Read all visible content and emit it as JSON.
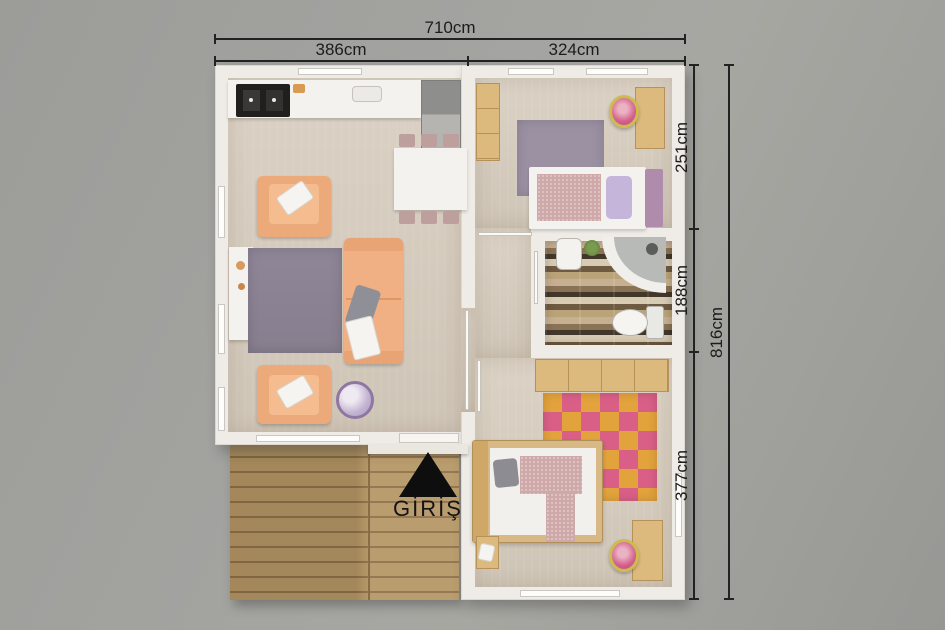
{
  "floorplan": {
    "entrance_label": "GİRİŞ",
    "dimensions": {
      "total_width": "710cm",
      "width_left": "386cm",
      "width_right": "324cm",
      "height_top": "251cm",
      "height_middle": "188cm",
      "height_bottom": "377cm",
      "total_height": "816cm"
    },
    "colors": {
      "background": "#a1a09d",
      "wall": "#efece7",
      "floor": "#d7cec1",
      "deck_wood": "#b49562",
      "sofa": "#f0b083",
      "living_rug": "#8d8494",
      "bedroom_rug": "#9b91a3",
      "patch_rug_orange": "#e2a23c",
      "patch_rug_pink": "#d95f86",
      "bath_tile": "#8a7355",
      "dimension_line": "#1f1f1f"
    }
  }
}
